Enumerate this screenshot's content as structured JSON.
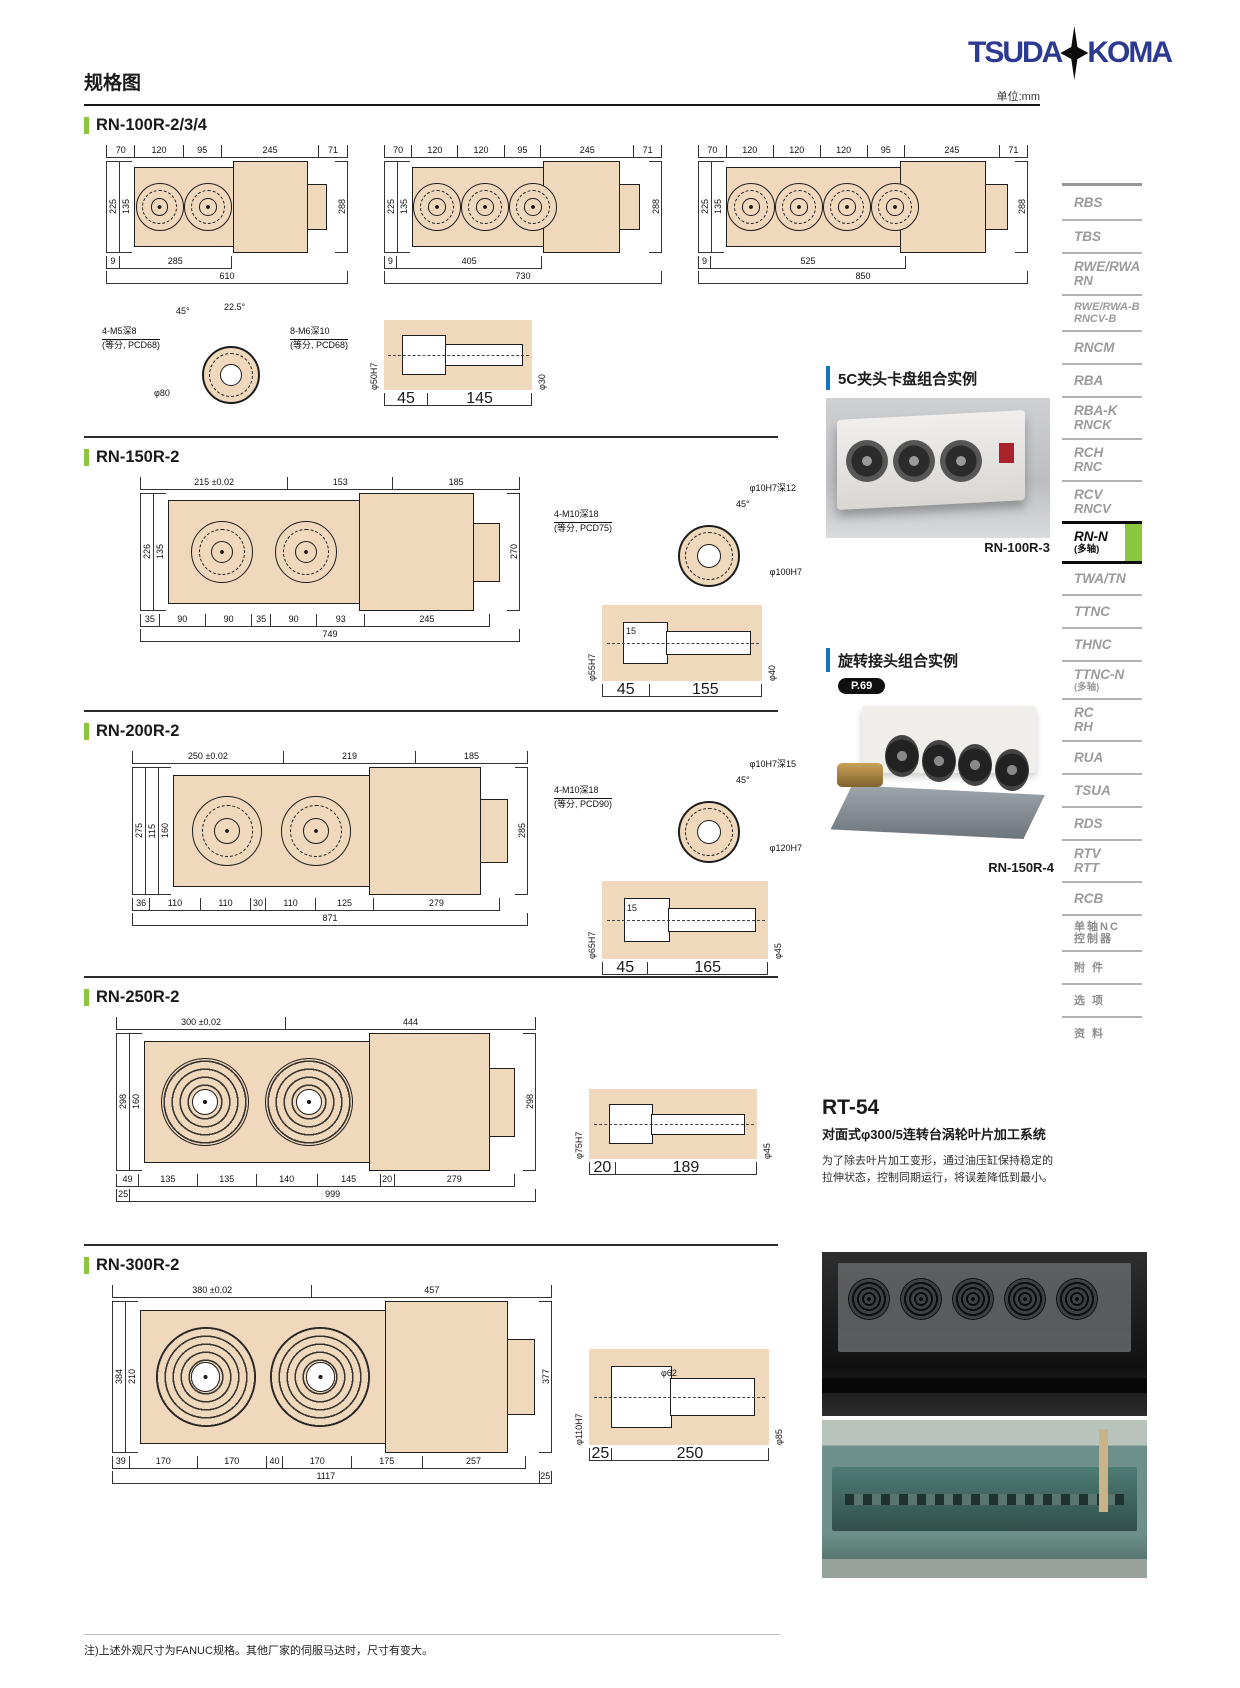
{
  "page": {
    "title": "规格图",
    "unit_label": "单位:mm",
    "logo_left": "TSUDA",
    "logo_right": "KOMA",
    "footnote": "注)上述外观尺寸为FANUC规格。其他厂家的伺服马达时，尺寸有变大。"
  },
  "sections": [
    {
      "title": "RN-100R-2/3/4",
      "drawings": [
        {
          "top_dims": [
            "70",
            "120",
            "95",
            "245",
            "71"
          ],
          "left_dims": [
            "225",
            "135"
          ],
          "right_dim": "288",
          "bottom_dims": [
            "9",
            "285"
          ],
          "total_dims": [
            "610"
          ]
        },
        {
          "top_dims": [
            "70",
            "120",
            "120",
            "95",
            "245",
            "71"
          ],
          "left_dims": [
            "225",
            "135"
          ],
          "right_dim": "288",
          "bottom_dims": [
            "9",
            "405"
          ],
          "total_dims": [
            "730"
          ]
        },
        {
          "top_dims": [
            "70",
            "120",
            "120",
            "120",
            "95",
            "245",
            "71"
          ],
          "left_dims": [
            "225",
            "135"
          ],
          "right_dim": "288",
          "bottom_dims": [
            "9",
            "525"
          ],
          "total_dims": [
            "850"
          ]
        }
      ],
      "flange": {
        "a1": "4-M5深8",
        "a2": "(等分, PCD68)",
        "b1": "8-M6深10",
        "b2": "(等分, PCD68)",
        "c": "45°",
        "d": "22.5°",
        "e": "φ80"
      },
      "shaft": {
        "left": "φ50H7",
        "right": "φ30",
        "d1": "45",
        "d2": "145"
      }
    },
    {
      "title": "RN-150R-2",
      "drawings": [
        {
          "top_dims": [
            "215 ±0.02",
            "153",
            "185"
          ],
          "left_dims": [
            "226",
            "135"
          ],
          "right_dim": "270",
          "bottom_dims": [
            "35",
            "90",
            "90",
            "35",
            "90",
            "93",
            "245"
          ],
          "total_dims": [
            "749"
          ]
        }
      ],
      "flange": {
        "a1": "4-M10深18",
        "a2": "(等分, PCD75)",
        "b1": "φ10H7深12",
        "c": "45°",
        "e": "φ100H7"
      },
      "shaft": {
        "left": "φ55H7",
        "mid": "15",
        "right": "φ40",
        "d1": "45",
        "d2": "155"
      }
    },
    {
      "title": "RN-200R-2",
      "drawings": [
        {
          "top_dims": [
            "250 ±0.02",
            "219",
            "185"
          ],
          "left_dims": [
            "275",
            "115",
            "160"
          ],
          "right_dim": "285",
          "bottom_dims": [
            "36",
            "110",
            "110",
            "30",
            "110",
            "125",
            "279"
          ],
          "total_dims": [
            "871"
          ]
        }
      ],
      "flange": {
        "a1": "4-M10深18",
        "a2": "(等分, PCD90)",
        "b1": "φ10H7深15",
        "c": "45°",
        "e": "φ120H7"
      },
      "shaft": {
        "left": "φ65H7",
        "mid": "15",
        "right": "φ45",
        "d1": "45",
        "d2": "165"
      }
    },
    {
      "title": "RN-250R-2",
      "drawings": [
        {
          "top_dims": [
            "300 ±0.02",
            "444"
          ],
          "left_dims": [
            "298",
            "160"
          ],
          "right_dim": "298",
          "bottom_dims": [
            "49",
            "135",
            "135",
            "140",
            "145",
            "20",
            "279"
          ],
          "total_dims": [
            "25",
            "999"
          ]
        }
      ],
      "shaft": {
        "left": "φ75H7",
        "right": "φ45",
        "d1": "20",
        "d2": "189"
      }
    },
    {
      "title": "RN-300R-2",
      "drawings": [
        {
          "top_dims": [
            "380 ±0.02",
            "457"
          ],
          "left_dims": [
            "384",
            "210"
          ],
          "right_dim": "377",
          "bottom_dims": [
            "39",
            "170",
            "170",
            "40",
            "170",
            "175",
            "257"
          ],
          "total_dims": [
            "1117",
            "25"
          ]
        }
      ],
      "shaft": {
        "left": "φ110H7",
        "mid": "φ62",
        "right": "φ85",
        "d1": "25",
        "d2": "250"
      }
    }
  ],
  "aside": {
    "example1": {
      "heading": "5C夹头卡盘组合实例",
      "caption": "RN-100R-3"
    },
    "example2": {
      "heading": "旋转接头组合实例",
      "badge": "P.69",
      "caption": "RN-150R-4"
    },
    "rt54": {
      "title": "RT-54",
      "subtitle": "对面式φ300/5连转台涡轮叶片加工系统",
      "body": "为了除去叶片加工变形，通过油压缸保持稳定的拉伸状态，控制同期运行，将误差降低到最小。"
    }
  },
  "sidebar": {
    "items": [
      {
        "label": "RBS"
      },
      {
        "label": "TBS"
      },
      {
        "label": "RWE/RWA",
        "sub": "RN"
      },
      {
        "label": "RWE/RWA-B",
        "sub": "RNCV-B",
        "cls": "small"
      },
      {
        "label": "RNCM"
      },
      {
        "label": "RBA"
      },
      {
        "label": "RBA-K",
        "sub": "RNCK"
      },
      {
        "label": "RCH",
        "sub": "RNC"
      },
      {
        "label": "RCV",
        "sub": "RNCV"
      },
      {
        "label": "RN-N",
        "note": "(多轴)",
        "active": true
      },
      {
        "label": "TWA/TN"
      },
      {
        "label": "TTNC"
      },
      {
        "label": "THNC"
      },
      {
        "label": "TTNC-N",
        "note": "(多轴)"
      },
      {
        "label": "RC",
        "sub": "RH"
      },
      {
        "label": "RUA"
      },
      {
        "label": "TSUA"
      },
      {
        "label": "RDS"
      },
      {
        "label": "RTV",
        "sub": "RTT"
      },
      {
        "label": "RCB"
      },
      {
        "label": "单轴NC",
        "sub": "控制器",
        "cls": "cjk"
      },
      {
        "label": "附 件",
        "cls": "cjk"
      },
      {
        "label": "选 项",
        "cls": "cjk"
      },
      {
        "label": "资 料",
        "cls": "cjk"
      }
    ]
  },
  "colors": {
    "accent_green": "#8cc63e",
    "accent_blue": "#1374bc",
    "logo_blue": "#2d3a92",
    "drawing_fill": "#f0d8bc",
    "sidebar_gray": "#9b9b9b"
  }
}
